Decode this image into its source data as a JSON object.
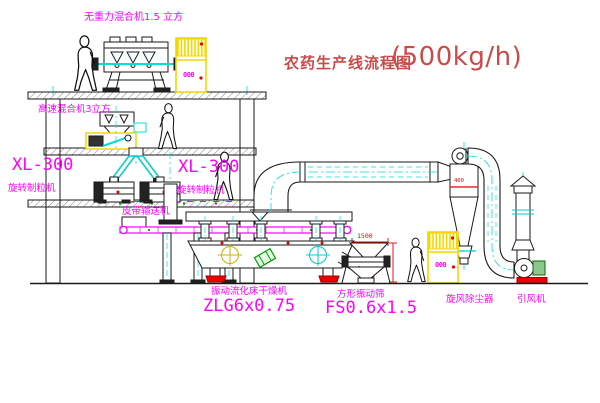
{
  "title": {
    "name": "农药生产线流程图",
    "capacity": "(500kg/h)"
  },
  "labels": {
    "gravity_mixer": "无重力混合机1.5 立方",
    "high_speed_mixer": "高速混合机3立方",
    "granulator_left_model": "XL-300",
    "granulator_left_name": "旋转制粒机",
    "granulator_right_model": "XL-300",
    "granulator_right_name": "旋转制粒机",
    "belt_conveyor": "皮带输送机",
    "dryer_name": "振动流化床干燥机",
    "dryer_model": "ZLG6x0.75",
    "sieve_name": "方形振动筛",
    "sieve_model": "FS0.6x1.5",
    "cyclone": "旋风除尘器",
    "fan": "引风机"
  },
  "dimensions": {
    "sieve_feed": "1500",
    "cyclone_duct": "400"
  },
  "cabinets": {
    "display_1": "000",
    "display_2": "000"
  },
  "colors": {
    "label_magenta": "#ff00ff",
    "title_red": "#cc4a4a",
    "centerline_cyan": "#00dddd",
    "cabinet_yellow": "#f2d800",
    "accent_red": "#ee0000",
    "accent_green": "#00a000",
    "line_black": "#1a1a1a"
  }
}
